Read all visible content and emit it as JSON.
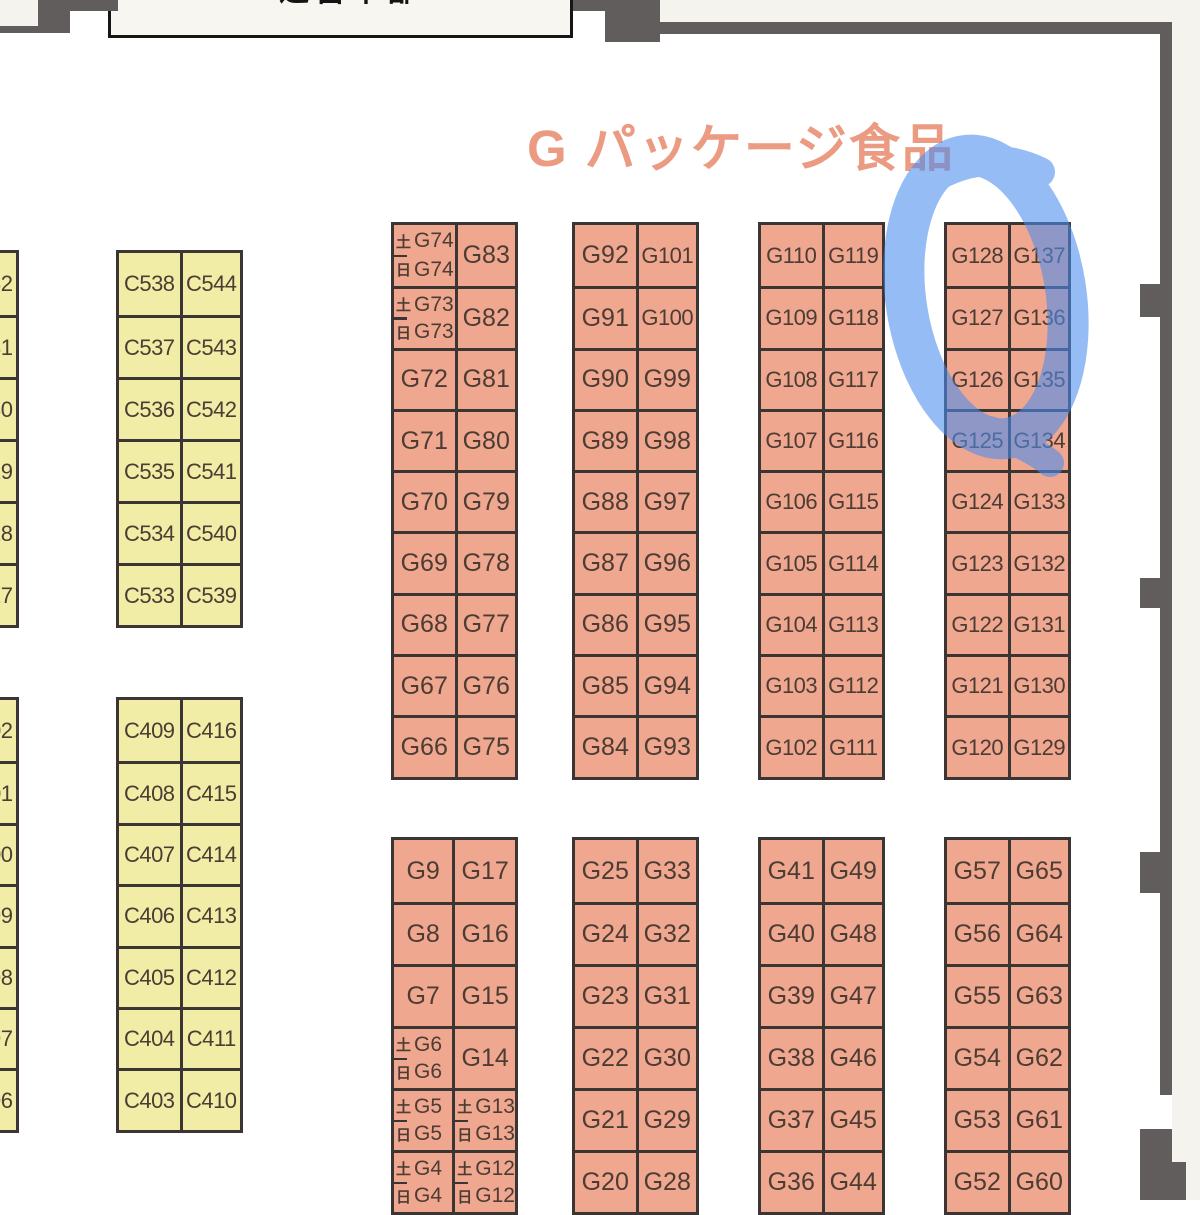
{
  "title": {
    "text": "G パッケージ食品"
  },
  "top_box": {
    "text": "運営本部"
  },
  "colors": {
    "booth_c_fill": "#f2eda6",
    "booth_g_fill": "#efa78f",
    "grid_border": "#3b3634",
    "wall": "#605d5c",
    "outside_bg": "#f5f3ee",
    "hall_bg": "#ffffff",
    "title_color": "#eb9b82",
    "marker_blue": "#4b8df0",
    "booth_text": "#4c3c34"
  },
  "c_section": {
    "upper_partial_column": [
      "C532",
      "C531",
      "C530",
      "C529",
      "C528",
      "C527"
    ],
    "upper_pairs": [
      [
        "C538",
        "C544"
      ],
      [
        "C537",
        "C543"
      ],
      [
        "C536",
        "C542"
      ],
      [
        "C535",
        "C541"
      ],
      [
        "C534",
        "C540"
      ],
      [
        "C533",
        "C539"
      ]
    ],
    "lower_partial_column": [
      "C402",
      "C401",
      "C400",
      "C399",
      "C398",
      "C397",
      "C396"
    ],
    "lower_pairs": [
      [
        "C409",
        "C416"
      ],
      [
        "C408",
        "C415"
      ],
      [
        "C407",
        "C414"
      ],
      [
        "C406",
        "C413"
      ],
      [
        "C405",
        "C412"
      ],
      [
        "C404",
        "C411"
      ],
      [
        "C403",
        "C410"
      ]
    ]
  },
  "g_section": {
    "upper_blocks": [
      {
        "rows": [
          [
            {
              "split": [
                "土G74",
                "日G74"
              ]
            },
            "G83"
          ],
          [
            {
              "split": [
                "土G73",
                "日G73"
              ]
            },
            "G82"
          ],
          [
            "G72",
            "G81"
          ],
          [
            "G71",
            "G80"
          ],
          [
            "G70",
            "G79"
          ],
          [
            "G69",
            "G78"
          ],
          [
            "G68",
            "G77"
          ],
          [
            "G67",
            "G76"
          ],
          [
            "G66",
            "G75"
          ]
        ]
      },
      {
        "rows": [
          [
            "G92",
            "G101"
          ],
          [
            "G91",
            "G100"
          ],
          [
            "G90",
            "G99"
          ],
          [
            "G89",
            "G98"
          ],
          [
            "G88",
            "G97"
          ],
          [
            "G87",
            "G96"
          ],
          [
            "G86",
            "G95"
          ],
          [
            "G85",
            "G94"
          ],
          [
            "G84",
            "G93"
          ]
        ]
      },
      {
        "rows": [
          [
            "G110",
            "G119"
          ],
          [
            "G109",
            "G118"
          ],
          [
            "G108",
            "G117"
          ],
          [
            "G107",
            "G116"
          ],
          [
            "G106",
            "G115"
          ],
          [
            "G105",
            "G114"
          ],
          [
            "G104",
            "G113"
          ],
          [
            "G103",
            "G112"
          ],
          [
            "G102",
            "G111"
          ]
        ]
      },
      {
        "rows": [
          [
            "G128",
            "G137"
          ],
          [
            "G127",
            "G136"
          ],
          [
            "G126",
            "G135"
          ],
          [
            "G125",
            "G134"
          ],
          [
            "G124",
            "G133"
          ],
          [
            "G123",
            "G132"
          ],
          [
            "G122",
            "G131"
          ],
          [
            "G121",
            "G130"
          ],
          [
            "G120",
            "G129"
          ]
        ]
      }
    ],
    "lower_blocks": [
      {
        "rows": [
          [
            "G9",
            "G17"
          ],
          [
            "G8",
            "G16"
          ],
          [
            "G7",
            "G15"
          ],
          [
            {
              "split": [
                "土G6",
                "日G6"
              ]
            },
            "G14"
          ],
          [
            {
              "split": [
                "土G5",
                "日G5"
              ]
            },
            {
              "split": [
                "土G13",
                "日G13"
              ]
            }
          ],
          [
            {
              "split": [
                "土G4",
                "日G4"
              ]
            },
            {
              "split": [
                "土G12",
                "日G12"
              ]
            }
          ]
        ]
      },
      {
        "rows": [
          [
            "G25",
            "G33"
          ],
          [
            "G24",
            "G32"
          ],
          [
            "G23",
            "G31"
          ],
          [
            "G22",
            "G30"
          ],
          [
            "G21",
            "G29"
          ],
          [
            "G20",
            "G28"
          ]
        ]
      },
      {
        "rows": [
          [
            "G41",
            "G49"
          ],
          [
            "G40",
            "G48"
          ],
          [
            "G39",
            "G47"
          ],
          [
            "G38",
            "G46"
          ],
          [
            "G37",
            "G45"
          ],
          [
            "G36",
            "G44"
          ]
        ]
      },
      {
        "rows": [
          [
            "G57",
            "G65"
          ],
          [
            "G56",
            "G64"
          ],
          [
            "G55",
            "G63"
          ],
          [
            "G54",
            "G62"
          ],
          [
            "G53",
            "G61"
          ],
          [
            "G52",
            "G60"
          ]
        ]
      }
    ]
  },
  "annotation": {
    "shape": "hand-drawn-circle",
    "highlights": "G125-G128 / G134-G137 block"
  }
}
